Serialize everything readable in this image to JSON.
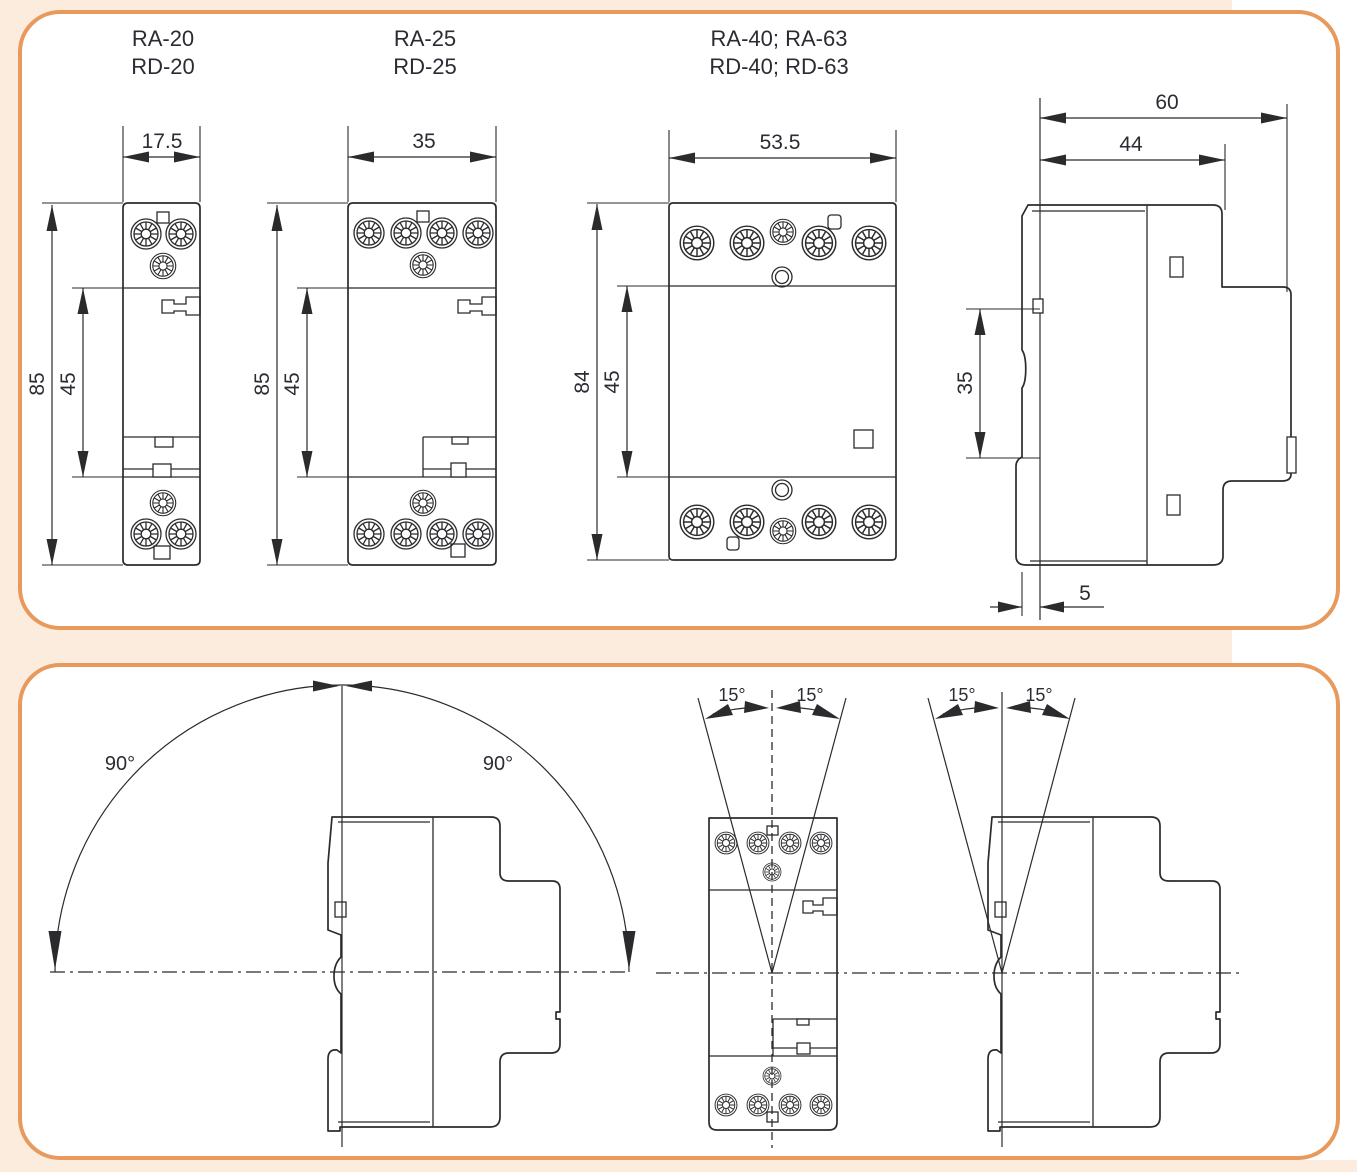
{
  "colors": {
    "page_bg": "#fbecdd",
    "panel_bg": "#ffffff",
    "panel_border": "#e8995c",
    "line": "#2b2b2e",
    "text": "#2b2b33"
  },
  "models": {
    "m1": {
      "l1": "RA-20",
      "l2": "RD-20"
    },
    "m2": {
      "l1": "RA-25",
      "l2": "RD-25"
    },
    "m3": {
      "l1": "RA-40; RA-63",
      "l2": "RD-40; RD-63"
    }
  },
  "dims": {
    "m1": {
      "w": "17.5",
      "h": "85",
      "inner": "45"
    },
    "m2": {
      "w": "35",
      "h": "85",
      "inner": "45"
    },
    "m3": {
      "w": "53.5",
      "h": "84",
      "inner": "45"
    },
    "side": {
      "total": "60",
      "front": "44",
      "rail": "35",
      "gap": "5"
    }
  },
  "angles": {
    "rot_l": "90°",
    "rot_r": "90°",
    "t1l": "15°",
    "t1r": "15°",
    "t2l": "15°",
    "t2r": "15°"
  }
}
